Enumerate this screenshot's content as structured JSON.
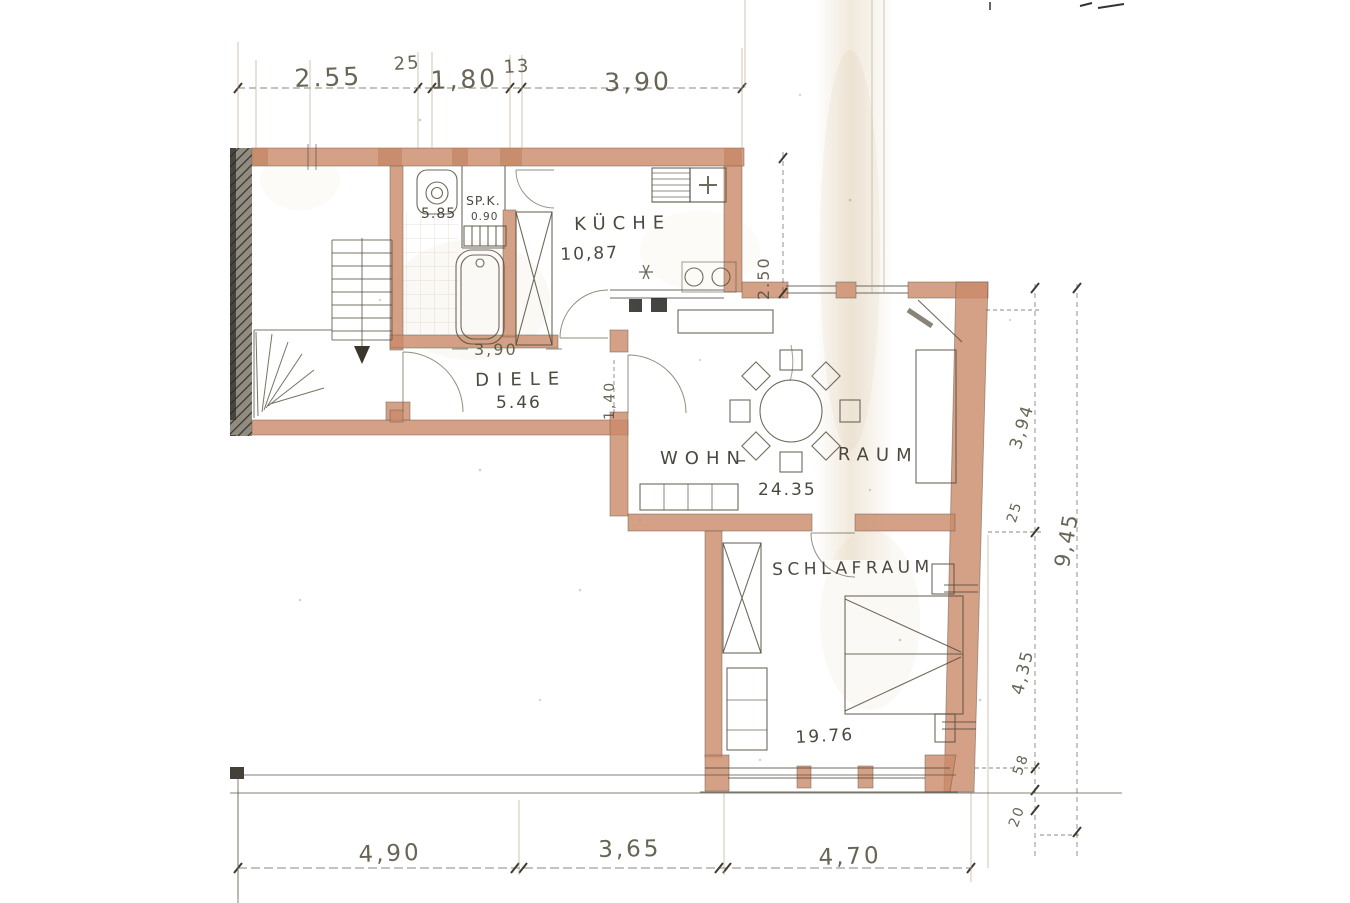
{
  "drawing": {
    "kind": "hand-drawn scanned floor plan",
    "language": "German"
  },
  "rooms": {
    "kueche": {
      "label": "KÜCHE",
      "area": "10,87"
    },
    "diele": {
      "label": "DIELE",
      "area": "5.46",
      "width": "3,90",
      "depth": "1,40"
    },
    "wohnraum": {
      "word1": "WOHN",
      "sep": "–",
      "word2": "RAUM",
      "area": "24.35"
    },
    "schlafraum": {
      "label": "SCHLAFRAUM",
      "area": "19.76"
    },
    "spk": {
      "label": "SP.K.",
      "area": "0.90"
    },
    "bad": {
      "area": "5.85"
    }
  },
  "dims": {
    "top": {
      "a": "2.55",
      "b": "25",
      "c": "1,80",
      "d": "13",
      "e": "3,90"
    },
    "right": {
      "kitchen_depth": "2.50",
      "a": "3,94",
      "b": "25",
      "total": "9,45",
      "c": "4,35",
      "d": "58",
      "e": "20"
    },
    "bottom": {
      "a": "4,90",
      "b": "3,65",
      "c": "4,70"
    }
  },
  "colors": {
    "wall": "#c98a69",
    "pencil": "#4b463c",
    "existing_wall_hatch": "#8d877b",
    "stain": "#cdb488",
    "paper": "#ffffff"
  }
}
